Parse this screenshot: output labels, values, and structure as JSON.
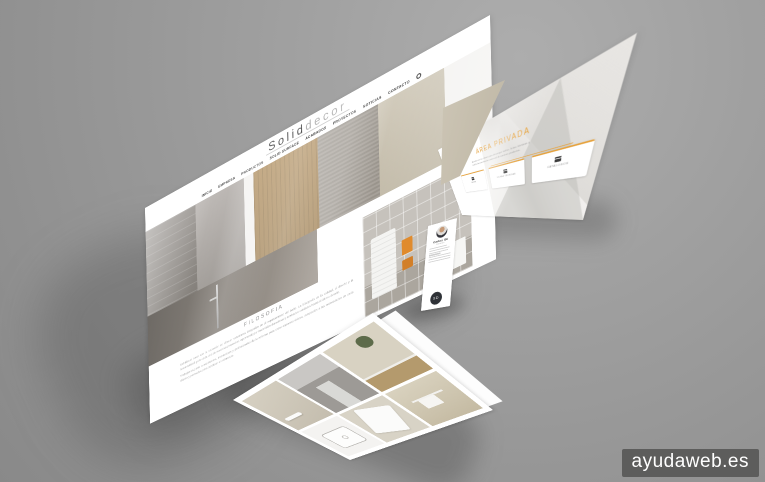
{
  "scene": {
    "watermark": "ayudaweb.es"
  },
  "main_site": {
    "logo_part1": "Solid",
    "logo_part2": "decor",
    "nav": [
      "INICIO",
      "EMPRESA",
      "PRODUCTOS",
      "SOLID SURFACE",
      "ACABADOS",
      "PROYECTOS",
      "NOTICIAS",
      "CONTACTO"
    ],
    "filosofia_title": "FILOSOFIA",
    "filosofia_p1": "Soliddecor nace con la vocación de ofrecer soluciones integrales en el equipamiento del baño. La búsqueda de la calidad, el diseño y la funcionalidad guía cada uno de nuestros proyectos, apostando por materiales duraderos y acabados cuidados hasta el último detalle.",
    "filosofia_p2": "Trabajamos junto a arquitectos, interioristas y profesionales de la reforma para crear espacios únicos, adaptados a las necesidades de cada cliente y pensados para perdurar en el tiempo."
  },
  "private_area": {
    "title": "ÁREA PRIVADA",
    "intro": "Accede con tus claves para descargar tarifas, fichas técnicas y toda la documentación comercial de nuestros productos.",
    "cards": [
      {
        "label": "TARIFA"
      },
      {
        "label": "FICHAS TÉCNICAS"
      },
      {
        "label": "CATÁLOGOS"
      }
    ]
  },
  "business_card": {
    "name": "Carlos Gil",
    "role": "Gerente",
    "monogram": "SD"
  },
  "gallery": {
    "photos": [
      "bathroom-beige-shelf",
      "bathroom-gray",
      "bathroom-plant",
      "washbasin-sketch",
      "bathtub-top-view",
      "towel-rack"
    ]
  },
  "colors": {
    "accent_orange": "#e6a23c",
    "background_gray": "#9a9a9a",
    "wood": "#a0804c",
    "beige": "#c9c2b2"
  }
}
